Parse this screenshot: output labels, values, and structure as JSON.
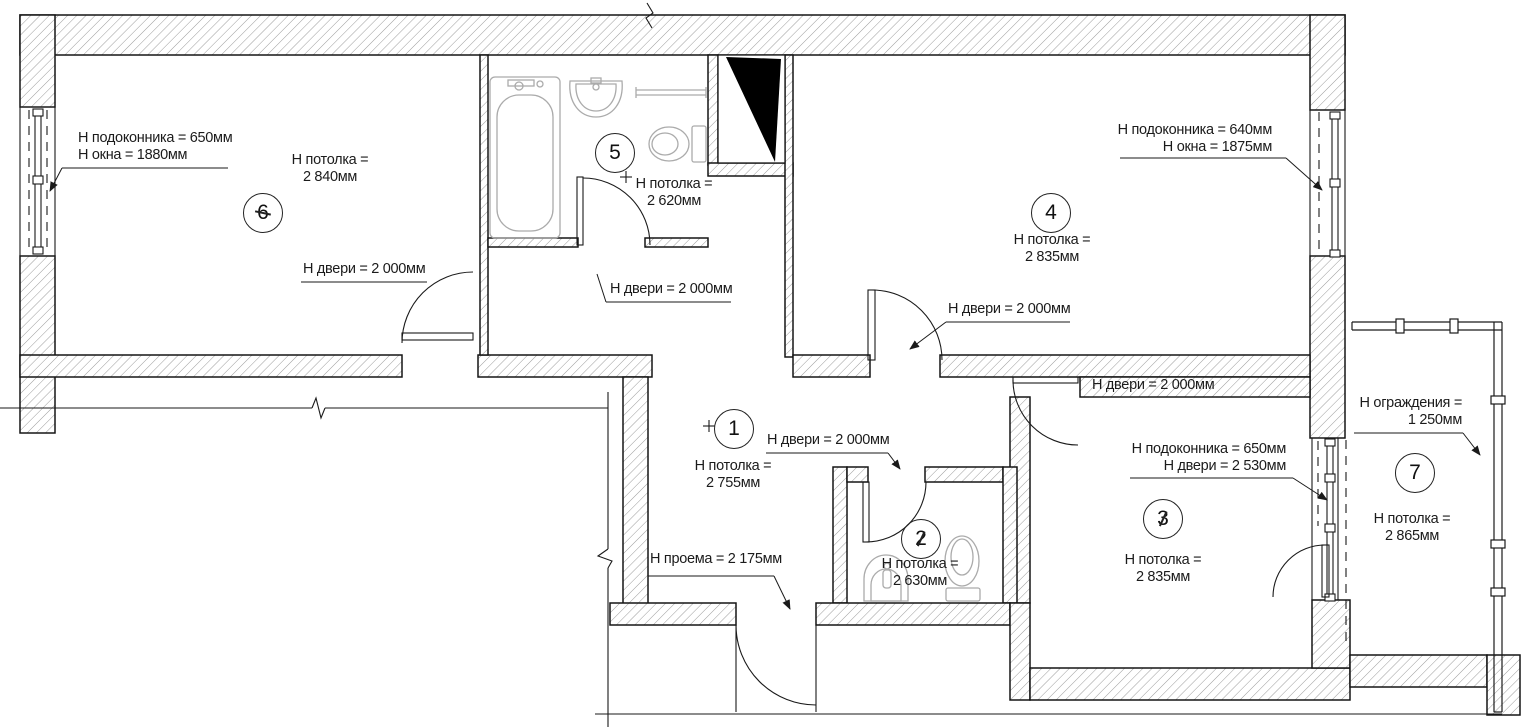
{
  "rooms": [
    {
      "number": "1",
      "ceiling_label": "Н потолка =",
      "ceiling_value": "2 755мм"
    },
    {
      "number": "2",
      "ceiling_label": "Н потолка =",
      "ceiling_value": "2 630мм"
    },
    {
      "number": "3",
      "ceiling_label": "Н потолка =",
      "ceiling_value": "2 835мм"
    },
    {
      "number": "4",
      "ceiling_label": "Н потолка =",
      "ceiling_value": "2 835мм"
    },
    {
      "number": "5",
      "ceiling_label": "Н потолка =",
      "ceiling_value": "2 620мм"
    },
    {
      "number": "6",
      "ceiling_label": "Н потолка =",
      "ceiling_value": "2 840мм"
    },
    {
      "number": "7",
      "ceiling_label": "Н потолка =",
      "ceiling_value": "2 865мм"
    }
  ],
  "annotations": {
    "left_window": {
      "line1": "Н подоконника = 650мм",
      "line2": "Н окна = 1880мм"
    },
    "right_window": {
      "line1": "Н подоконника = 640мм",
      "line2": "Н окна = 1875мм"
    },
    "balcony_door": {
      "line1": "Н подоконника = 650мм",
      "line2": "Н двери = 2 530мм"
    },
    "railing": {
      "line1": "Н ограждения =",
      "line2": "1 250мм"
    },
    "opening": {
      "text": "Н проема = 2 175мм"
    },
    "doors": [
      "Н двери = 2 000мм",
      "Н двери = 2 000мм",
      "Н двери = 2 000мм",
      "Н двери = 2 000мм",
      "Н двери = 2 000мм"
    ]
  },
  "colors": {
    "line": "#1a1a1a",
    "fixture": "#ababab",
    "hatch": "#666666",
    "background": "#ffffff"
  }
}
